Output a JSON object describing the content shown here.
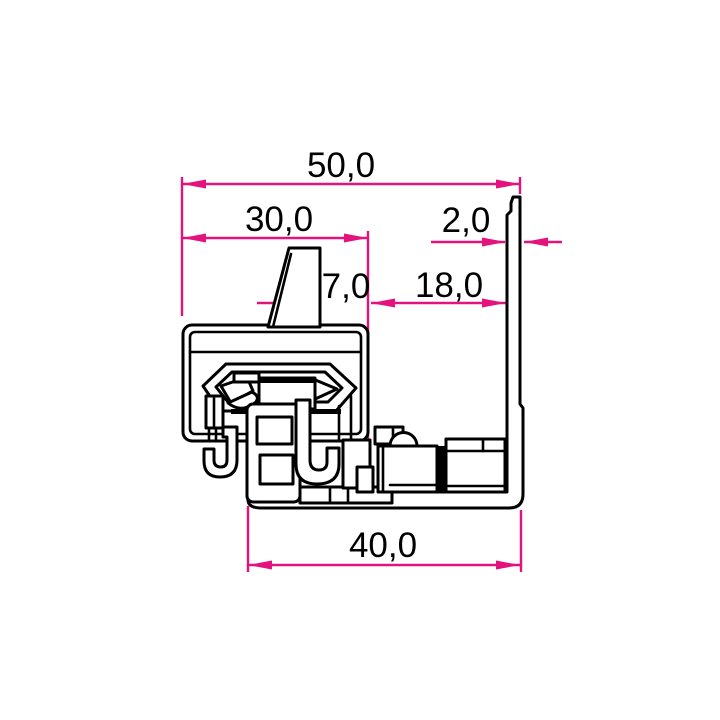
{
  "meta": {
    "type": "technical-drawing",
    "view": "profile-cross-section",
    "decimal_style": "comma"
  },
  "colors": {
    "dimension_lines": "#e3127c",
    "outline": "#000000",
    "background": "#ffffff",
    "text": "#000000"
  },
  "dimensions": {
    "total_width": {
      "label": "50,0",
      "value_mm": 50.0
    },
    "cap_width": {
      "label": "30,0",
      "value_mm": 30.0
    },
    "wall_thickness": {
      "label": "2,0",
      "value_mm": 2.0
    },
    "fin_offset": {
      "label": "7,0",
      "value_mm": 7.0
    },
    "gap_width": {
      "label": "18,0",
      "value_mm": 18.0
    },
    "base_width": {
      "label": "40,0",
      "value_mm": 40.0
    }
  }
}
